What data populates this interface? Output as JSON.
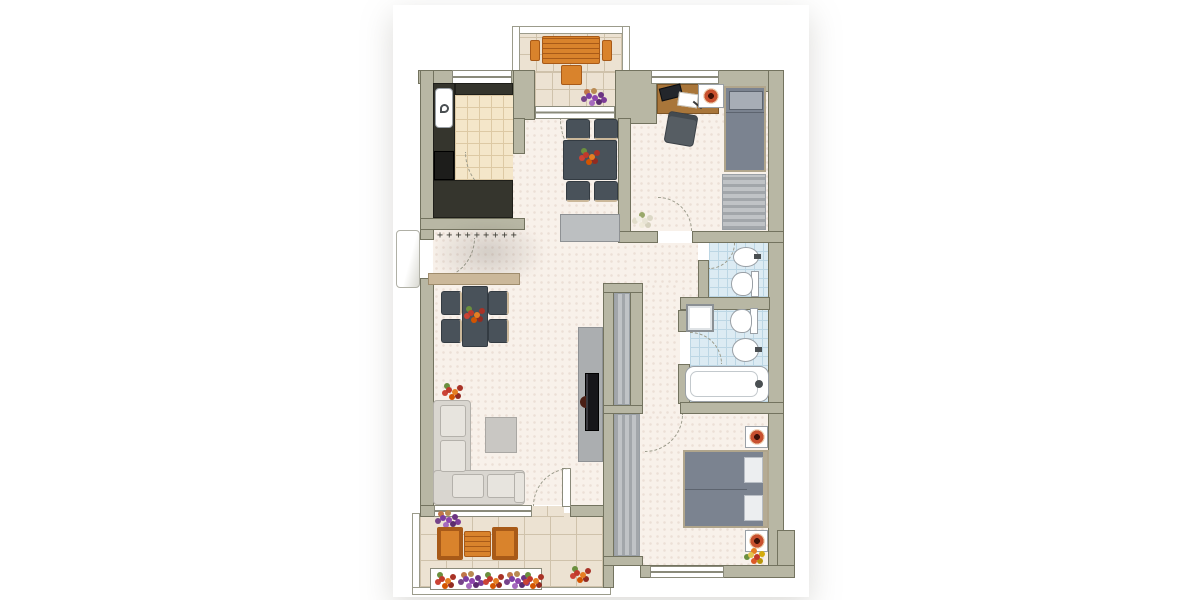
{
  "scene": {
    "kind": "apartment-floor-plan-top-view",
    "background": "#ffffff",
    "no_visible_text": true
  },
  "palette": {
    "wall": "#b8b7a4",
    "wall_edge": "#73735f",
    "carpet": "#f8f1ea",
    "kitchen_floor": "#f4e6c9",
    "kitchen_line": "#ddc9a4",
    "tile": "#ece2d2",
    "tile_line": "#cfc2ab",
    "bath_floor": "#dcebf3",
    "bath_line": "#bcd6e4",
    "counter": "#35352d",
    "counter_edge": "#1f1f1a",
    "furn_dark": "#49525a",
    "furn_dark_edge": "#333b42",
    "wood": "#a9763a",
    "wood_edge": "#7e5526",
    "wood_light": "#cbb89a",
    "orange": "#d9832c",
    "orange_edge": "#a85a18",
    "sofa": "#d9d6d0",
    "sofa_hi": "#e7e4de",
    "sofa_edge": "#b4b1ab",
    "bed": "#7b8390",
    "bed_edge": "#5d646f",
    "pillow": "#a7adb6",
    "closet_a": "#a2a6aa",
    "closet_b": "#c0c3c6",
    "gray_panel": "#abaeb0",
    "tv": "#16161a",
    "fixture_edge": "#9aa0a6",
    "lamp": "#c8502e",
    "arc": "#9b9b8b",
    "window_line": "#8a8a7a",
    "radiator": "#3c3c34",
    "sideboard": "#bcbfc1",
    "sideboard_edge": "#8e9194"
  },
  "decor": {
    "radiator_marks": "+++++++++"
  },
  "rooms": {
    "kitchen": {
      "label": "Kitchen",
      "furniture": [
        "l-counter",
        "sink",
        "stove",
        "door-arc"
      ]
    },
    "dining_living": {
      "label": "Dining / Living room",
      "furniture": [
        "dining-table",
        "4-chairs",
        "hall-table",
        "4-chairs",
        "sideboard",
        "console",
        "l-sofa",
        "coffee-table",
        "tv-wall",
        "flowers"
      ]
    },
    "bedroom_small": {
      "label": "Small bedroom / study",
      "furniture": [
        "desk",
        "desk-chair",
        "laptop",
        "single-bed",
        "nightstand",
        "wardrobe",
        "flowers"
      ]
    },
    "bathroom_small": {
      "label": "Small bathroom",
      "furniture": [
        "washbasin",
        "toilet"
      ]
    },
    "bathroom_large": {
      "label": "Large bathroom",
      "furniture": [
        "washing-machine",
        "toilet",
        "washbasin",
        "bathtub"
      ]
    },
    "hallway": {
      "label": "Hallway",
      "furniture": [
        "built-in-wardrobe",
        "radiator",
        "entry-console"
      ]
    },
    "master_bedroom": {
      "label": "Master bedroom",
      "furniture": [
        "double-bed",
        "2-nightstands",
        "2-lamps",
        "wardrobe",
        "flowers"
      ]
    },
    "balcony_top": {
      "label": "Top balcony",
      "furniture": [
        "orange-table",
        "2-benches",
        "chair",
        "flowers"
      ]
    },
    "balcony_bottom": {
      "label": "Bottom balcony",
      "furniture": [
        "2-orange-armchairs",
        "slat-table",
        "flower-box",
        "flowers"
      ]
    }
  }
}
